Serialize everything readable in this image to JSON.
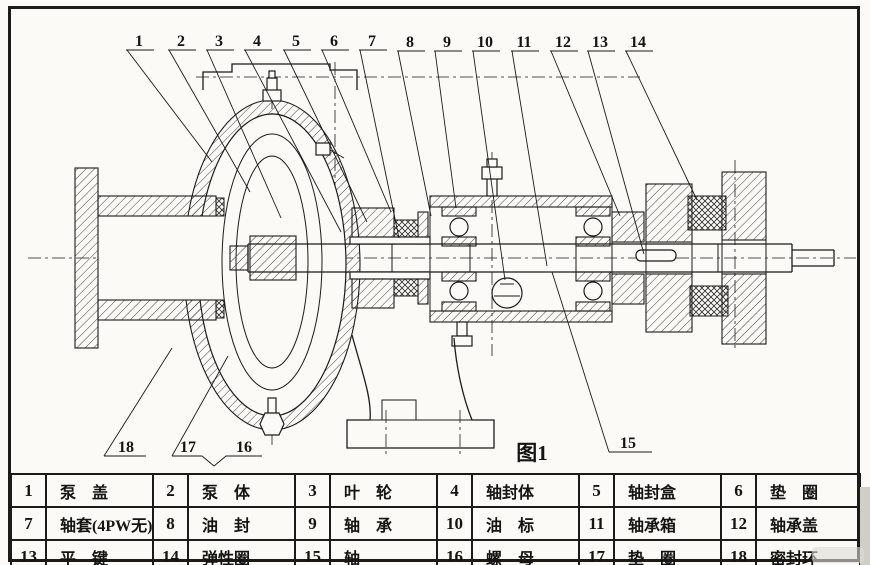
{
  "figure": {
    "caption": "图1",
    "callouts_top": [
      "1",
      "2",
      "3",
      "4",
      "5",
      "6",
      "7",
      "8",
      "9",
      "10",
      "11",
      "12",
      "13",
      "14"
    ],
    "callouts_bottom": [
      "18",
      "17",
      "16",
      "15"
    ]
  },
  "parts_table": {
    "rows": [
      [
        {
          "no": "1",
          "name": "泵　盖"
        },
        {
          "no": "2",
          "name": "泵　体"
        },
        {
          "no": "3",
          "name": "叶　轮"
        },
        {
          "no": "4",
          "name": "轴封体"
        },
        {
          "no": "5",
          "name": "轴封盒"
        },
        {
          "no": "6",
          "name": "垫　圈"
        }
      ],
      [
        {
          "no": "7",
          "name": "轴套(4PW无)"
        },
        {
          "no": "8",
          "name": "油　封"
        },
        {
          "no": "9",
          "name": "轴　承"
        },
        {
          "no": "10",
          "name": "油　标"
        },
        {
          "no": "11",
          "name": "轴承箱"
        },
        {
          "no": "12",
          "name": "轴承盖"
        }
      ],
      [
        {
          "no": "13",
          "name": "平　键"
        },
        {
          "no": "14",
          "name": "弹性圈"
        },
        {
          "no": "15",
          "name": "轴"
        },
        {
          "no": "16",
          "name": "螺　母"
        },
        {
          "no": "17",
          "name": "垫　圈"
        },
        {
          "no": "18",
          "name": "密封环"
        }
      ]
    ]
  },
  "colors": {
    "ink": "#1b1b1b",
    "paper": "#fbfaf6"
  }
}
